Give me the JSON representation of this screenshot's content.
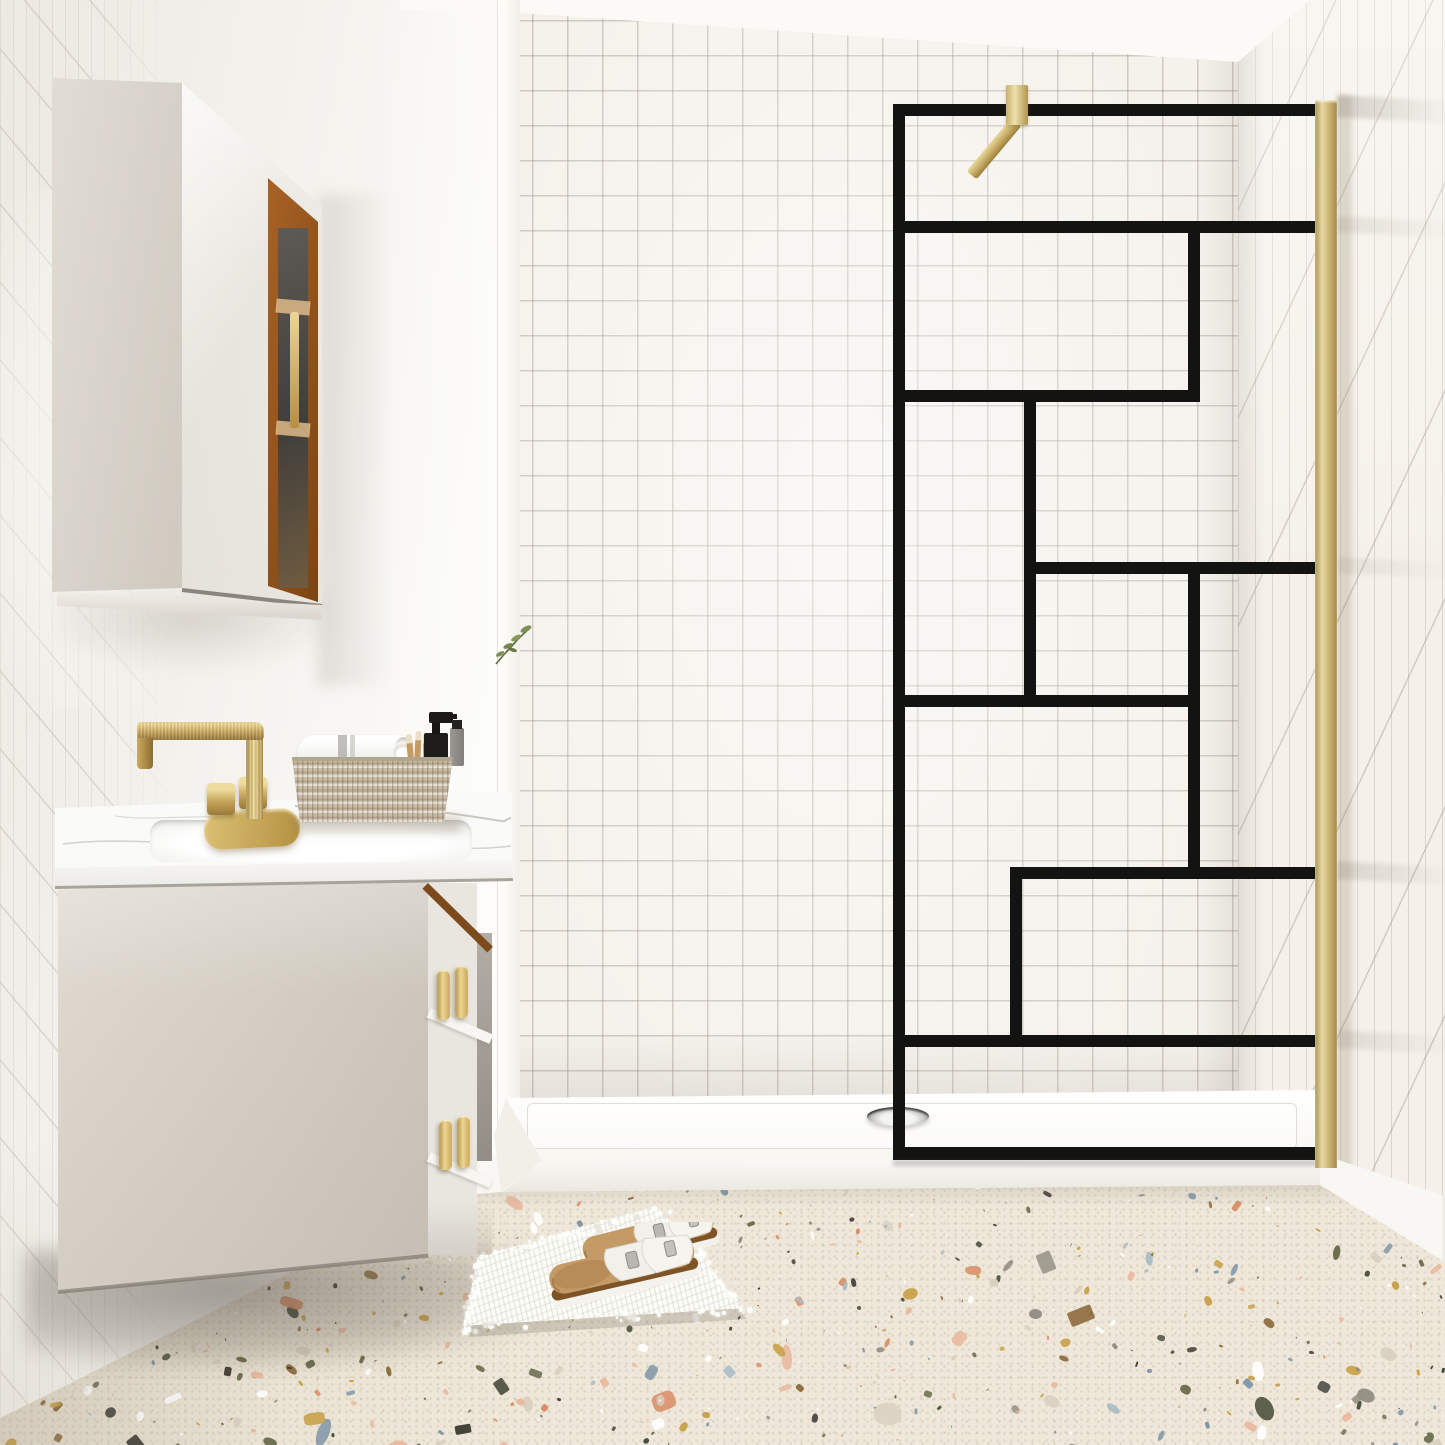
{
  "page": {
    "title": "Minimalist bathroom with black-grid walk-in shower screen",
    "kind": "photorealistic interior render, no visible text"
  },
  "labels": {
    "room": "Minimalist bathroom scene",
    "left_wall": "White wall with diagonal tile accents",
    "back_wall": "White square-tile shower wall",
    "right_wall": "White tiled side wall",
    "ceiling": "Ceiling",
    "niche": "Bright wall corner reveal",
    "plant": "Green sprig",
    "wall_cabinet": "Wall-mounted mirrored cabinet with walnut open shelf",
    "vanity": "Floating greige vanity with marble top",
    "sink": "Undermount basin",
    "faucet": "Brushed gold two-handle faucet",
    "basket": "Whitewashed rattan basket",
    "towel": "Rolled white towel with grey stripe",
    "toothbrushes": "Wooden toothbrushes",
    "soap_pump": "Black soap dispenser",
    "lotion_bottle": "Grey lotion bottle",
    "drawer_pulls": "Brass double drawer pulls",
    "shower_screen": "Walk-in shower screen with black geometric grid",
    "glass": "Clear glass panel",
    "support_bar": "Brass wall support bar",
    "wall_profile": "Brass wall profile",
    "shower_tray": "Low-profile white shower tray",
    "drain": "Round chrome drain",
    "baseboard": "White baseboard",
    "floor": "Multicolour terrazzo floor",
    "bath_mat": "White shaggy bath mat",
    "sandals": "White double-buckle cork sandals"
  },
  "colors": {
    "frame_black": "#131312",
    "brass": "#d8c488",
    "brass_deep": "#a88c49",
    "greige": "#d6d0c7",
    "walnut": "#8a4f1e",
    "marble": "#fafaf8",
    "tile": "#f5f2ec",
    "grout": "#cfc9be",
    "tray": "#fbfaf6",
    "terrazzo_base": "#efe8da",
    "cork": "#7e5426",
    "footbed": "#c49a66"
  },
  "terrazzo": {
    "seed": 20240613,
    "chip_count": 780,
    "palette": [
      {
        "color": "#6b6d4e",
        "weight": 10
      },
      {
        "color": "#474d3a",
        "weight": 7
      },
      {
        "color": "#7f95a6",
        "weight": 8
      },
      {
        "color": "#a9bcc6",
        "weight": 5
      },
      {
        "color": "#e9b99e",
        "weight": 11
      },
      {
        "color": "#d98f67",
        "weight": 7
      },
      {
        "color": "#c8a24a",
        "weight": 9
      },
      {
        "color": "#8a6a3a",
        "weight": 6
      },
      {
        "color": "#3f3e36",
        "weight": 7
      },
      {
        "color": "#948f84",
        "weight": 8
      },
      {
        "color": "#ffffff",
        "weight": 10
      },
      {
        "color": "#d9cfc0",
        "weight": 12
      }
    ]
  },
  "mat": {
    "tuft_count": 120
  }
}
